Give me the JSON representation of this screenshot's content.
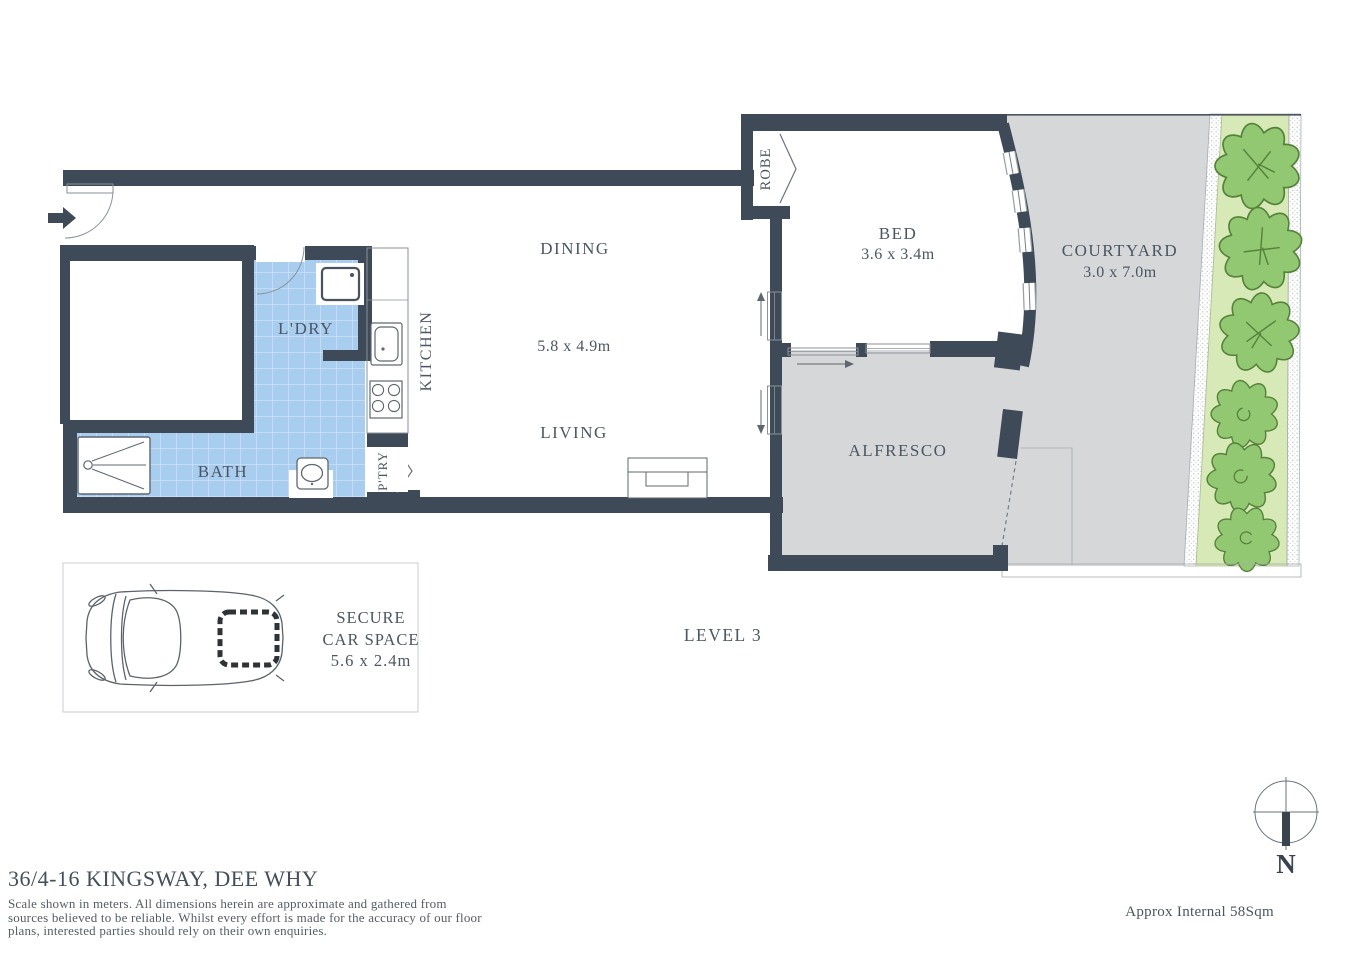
{
  "plan": {
    "rooms": {
      "dining": "DINING",
      "living": "LIVING",
      "living_dims": "5.8 x 4.9m",
      "kitchen": "KITCHEN",
      "laundry": "L'DRY",
      "bath": "BATH",
      "pantry": "P'TRY",
      "robe": "ROBE",
      "bed": "BED",
      "bed_dims": "3.6 x 3.4m",
      "courtyard": "COURTYARD",
      "courtyard_dims": "3.0 x 7.0m",
      "alfresco": "ALFRESCO"
    },
    "car_space": {
      "line1": "SECURE",
      "line2": "CAR SPACE",
      "line3": "5.6 x 2.4m"
    },
    "level": "LEVEL 3",
    "compass_n": "N"
  },
  "footer": {
    "address": "36/4-16 KINGSWAY, DEE WHY",
    "disclaimer": [
      "Scale shown in meters. All dimensions herein are approximate and gathered from",
      "sources believed to be reliable. Whilst every effort is made for the accuracy of our floor",
      "plans, interested parties should rely on their own enquiries."
    ],
    "area_note": "Approx Internal 58Sqm"
  },
  "colors": {
    "wall": "#3E4A57",
    "tile": "#A9CDEF",
    "outdoor": "#D5D7D9",
    "garden": "#D7E9B6",
    "tree": "#93C873",
    "tree_stroke": "#55823A",
    "text": "#4C5663"
  }
}
